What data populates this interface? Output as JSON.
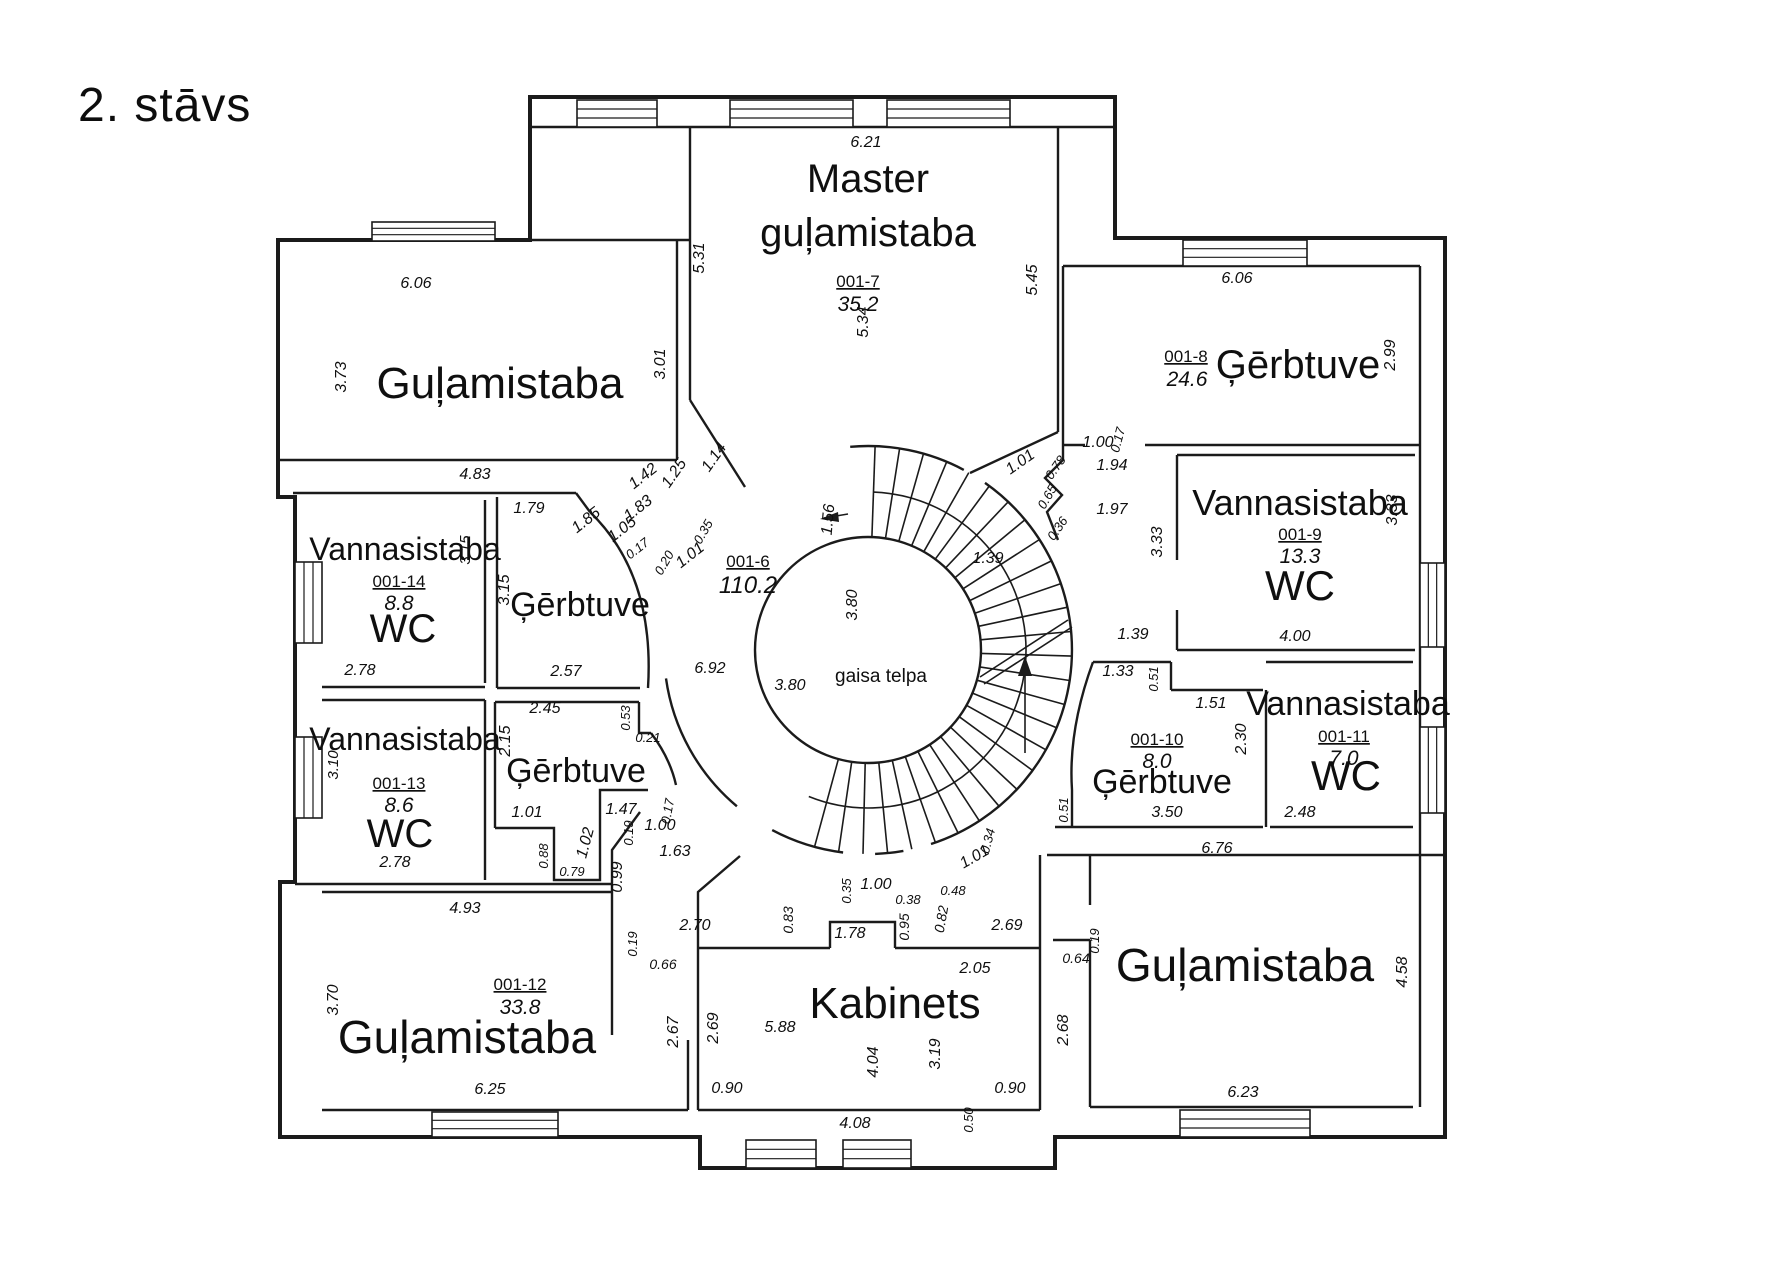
{
  "title": "2. stāvs",
  "central_void_label": "gaisa telpa",
  "rooms": [
    {
      "name": "Guļamistaba",
      "number": "",
      "area": "",
      "position": "top-left"
    },
    {
      "name": "Master guļamistaba",
      "number": "001-7",
      "area": "35.2",
      "position": "top-center"
    },
    {
      "name": "Ģērbtuve",
      "number": "001-8",
      "area": "24.6",
      "position": "top-right"
    },
    {
      "name": "Vannasistaba WC",
      "number": "001-9",
      "area": "13.3",
      "position": "right"
    },
    {
      "name": "Vannasistaba WC",
      "number": "001-14",
      "area": "8.8",
      "position": "left-upper"
    },
    {
      "name": "Ģērbtuve",
      "number": "",
      "area": "",
      "position": "left-upper-center"
    },
    {
      "name": "Halle",
      "number": "001-6",
      "area": "110.2",
      "position": "center"
    },
    {
      "name": "Vannasistaba WC",
      "number": "001-13",
      "area": "8.6",
      "position": "left-lower"
    },
    {
      "name": "Ģērbtuve",
      "number": "",
      "area": "",
      "position": "left-lower-center"
    },
    {
      "name": "Ģērbtuve",
      "number": "001-10",
      "area": "8.0",
      "position": "right-lower"
    },
    {
      "name": "Vannasistaba WC",
      "number": "001-11",
      "area": "7.0",
      "position": "right-lower-2"
    },
    {
      "name": "Guļamistaba",
      "number": "001-12",
      "area": "33.8",
      "position": "bottom-left"
    },
    {
      "name": "Kabinets",
      "number": "",
      "area": "",
      "position": "bottom-center"
    },
    {
      "name": "Guļamistaba",
      "number": "",
      "area": "",
      "position": "bottom-right"
    }
  ],
  "labels": [
    {
      "t": "Guļamistaba",
      "x": 500,
      "y": 398,
      "s": 44,
      "r": 0,
      "k": "n"
    },
    {
      "t": "Master",
      "x": 868,
      "y": 192,
      "s": 40,
      "r": 0,
      "k": "n"
    },
    {
      "t": "guļamistaba",
      "x": 868,
      "y": 246,
      "s": 40,
      "r": 0,
      "k": "n"
    },
    {
      "t": "Ģērbtuve",
      "x": 1298,
      "y": 378,
      "s": 40,
      "r": 0,
      "k": "n"
    },
    {
      "t": "Vannasistaba",
      "x": 1300,
      "y": 515,
      "s": 36,
      "r": 0,
      "k": "n"
    },
    {
      "t": "WC",
      "x": 1300,
      "y": 600,
      "s": 42,
      "r": 0,
      "k": "n"
    },
    {
      "t": "Vannasistaba",
      "x": 405,
      "y": 560,
      "s": 32,
      "r": 0,
      "k": "n"
    },
    {
      "t": "WC",
      "x": 403,
      "y": 642,
      "s": 40,
      "r": 0,
      "k": "n"
    },
    {
      "t": "Ģērbtuve",
      "x": 580,
      "y": 616,
      "s": 34,
      "r": 0,
      "k": "n"
    },
    {
      "t": "Vannasistaba",
      "x": 405,
      "y": 750,
      "s": 32,
      "r": 0,
      "k": "n"
    },
    {
      "t": "WC",
      "x": 400,
      "y": 847,
      "s": 40,
      "r": 0,
      "k": "n"
    },
    {
      "t": "Ģērbtuve",
      "x": 576,
      "y": 782,
      "s": 34,
      "r": 0,
      "k": "n"
    },
    {
      "t": "Ģērbtuve",
      "x": 1162,
      "y": 793,
      "s": 34,
      "r": 0,
      "k": "n"
    },
    {
      "t": "Vannasistaba",
      "x": 1348,
      "y": 715,
      "s": 34,
      "r": 0,
      "k": "n"
    },
    {
      "t": "WC",
      "x": 1346,
      "y": 790,
      "s": 42,
      "r": 0,
      "k": "n"
    },
    {
      "t": "Guļamistaba",
      "x": 467,
      "y": 1053,
      "s": 46,
      "r": 0,
      "k": "n"
    },
    {
      "t": "Kabinets",
      "x": 895,
      "y": 1018,
      "s": 44,
      "r": 0,
      "k": "n"
    },
    {
      "t": "Guļamistaba",
      "x": 1245,
      "y": 981,
      "s": 46,
      "r": 0,
      "k": "n"
    },
    {
      "t": "gaisa telpa",
      "x": 881,
      "y": 682,
      "s": 19,
      "r": 0,
      "k": "t"
    },
    {
      "t": "001-7",
      "x": 858,
      "y": 287,
      "s": 17,
      "r": 0,
      "k": "u"
    },
    {
      "t": "35.2",
      "x": 858,
      "y": 311,
      "s": 21,
      "r": 0,
      "k": "a"
    },
    {
      "t": "001-8",
      "x": 1186,
      "y": 362,
      "s": 17,
      "r": 0,
      "k": "u"
    },
    {
      "t": "24.6",
      "x": 1187,
      "y": 386,
      "s": 21,
      "r": 0,
      "k": "a"
    },
    {
      "t": "001-9",
      "x": 1300,
      "y": 540,
      "s": 17,
      "r": 0,
      "k": "u"
    },
    {
      "t": "13.3",
      "x": 1300,
      "y": 563,
      "s": 21,
      "r": 0,
      "k": "a"
    },
    {
      "t": "001-14",
      "x": 399,
      "y": 587,
      "s": 17,
      "r": 0,
      "k": "u"
    },
    {
      "t": "8.8",
      "x": 399,
      "y": 610,
      "s": 21,
      "r": 0,
      "k": "a"
    },
    {
      "t": "001-13",
      "x": 399,
      "y": 789,
      "s": 17,
      "r": 0,
      "k": "u"
    },
    {
      "t": "8.6",
      "x": 399,
      "y": 812,
      "s": 21,
      "r": 0,
      "k": "a"
    },
    {
      "t": "001-10",
      "x": 1157,
      "y": 745,
      "s": 17,
      "r": 0,
      "k": "u"
    },
    {
      "t": "8.0",
      "x": 1157,
      "y": 768,
      "s": 21,
      "r": 0,
      "k": "a"
    },
    {
      "t": "001-11",
      "x": 1344,
      "y": 742,
      "s": 17,
      "r": 0,
      "k": "u"
    },
    {
      "t": "7.0",
      "x": 1344,
      "y": 765,
      "s": 21,
      "r": 0,
      "k": "a"
    },
    {
      "t": "001-12",
      "x": 520,
      "y": 990,
      "s": 17,
      "r": 0,
      "k": "u"
    },
    {
      "t": "33.8",
      "x": 520,
      "y": 1014,
      "s": 21,
      "r": 0,
      "k": "a"
    },
    {
      "t": "001-6",
      "x": 748,
      "y": 567,
      "s": 17,
      "r": 0,
      "k": "u"
    },
    {
      "t": "110.2",
      "x": 748,
      "y": 593,
      "s": 24,
      "r": 0,
      "k": "a"
    },
    {
      "t": "6.21",
      "x": 866,
      "y": 147,
      "s": 16,
      "r": 0,
      "k": "d"
    },
    {
      "t": "5.31",
      "x": 704,
      "y": 258,
      "s": 16,
      "r": -90,
      "k": "d"
    },
    {
      "t": "5.45",
      "x": 1037,
      "y": 280,
      "s": 16,
      "r": -90,
      "k": "d"
    },
    {
      "t": "5.34",
      "x": 868,
      "y": 322,
      "s": 16,
      "r": -90,
      "k": "d"
    },
    {
      "t": "6.06",
      "x": 416,
      "y": 288,
      "s": 16,
      "r": 0,
      "k": "d"
    },
    {
      "t": "3.73",
      "x": 346,
      "y": 377,
      "s": 16,
      "r": -90,
      "k": "d"
    },
    {
      "t": "3.01",
      "x": 665,
      "y": 364,
      "s": 16,
      "r": -90,
      "k": "d"
    },
    {
      "t": "6.06",
      "x": 1237,
      "y": 283,
      "s": 16,
      "r": 0,
      "k": "d"
    },
    {
      "t": "2.99",
      "x": 1395,
      "y": 355,
      "s": 16,
      "r": -90,
      "k": "d"
    },
    {
      "t": "4.83",
      "x": 475,
      "y": 479,
      "s": 16,
      "r": 0,
      "k": "d"
    },
    {
      "t": "1.79",
      "x": 529,
      "y": 513,
      "s": 16,
      "r": 0,
      "k": "d"
    },
    {
      "t": "2.78",
      "x": 360,
      "y": 675,
      "s": 16,
      "r": 0,
      "k": "d"
    },
    {
      "t": "3.15",
      "x": 470,
      "y": 550,
      "s": 15,
      "r": -90,
      "k": "d"
    },
    {
      "t": "3.15",
      "x": 509,
      "y": 590,
      "s": 16,
      "r": -90,
      "k": "d"
    },
    {
      "t": "2.57",
      "x": 566,
      "y": 676,
      "s": 16,
      "r": 0,
      "k": "d"
    },
    {
      "t": "1.42",
      "x": 646,
      "y": 480,
      "s": 16,
      "r": -38,
      "k": "d"
    },
    {
      "t": "1.25",
      "x": 678,
      "y": 476,
      "s": 16,
      "r": -55,
      "k": "d"
    },
    {
      "t": "1.83",
      "x": 641,
      "y": 512,
      "s": 16,
      "r": -38,
      "k": "d"
    },
    {
      "t": "1.14",
      "x": 718,
      "y": 460,
      "s": 16,
      "r": -55,
      "k": "d"
    },
    {
      "t": "1.85",
      "x": 589,
      "y": 524,
      "s": 16,
      "r": -38,
      "k": "d"
    },
    {
      "t": "1.05",
      "x": 625,
      "y": 533,
      "s": 16,
      "r": -38,
      "k": "d"
    },
    {
      "t": "0.17",
      "x": 640,
      "y": 552,
      "s": 13,
      "r": -38,
      "k": "d"
    },
    {
      "t": "0.20",
      "x": 668,
      "y": 565,
      "s": 13,
      "r": -60,
      "k": "d"
    },
    {
      "t": "0.35",
      "x": 707,
      "y": 534,
      "s": 13,
      "r": -60,
      "k": "d"
    },
    {
      "t": "1.01",
      "x": 693,
      "y": 559,
      "s": 16,
      "r": -38,
      "k": "d"
    },
    {
      "t": "1.56",
      "x": 833,
      "y": 520,
      "s": 16,
      "r": -85,
      "k": "d"
    },
    {
      "t": "3.80",
      "x": 857,
      "y": 605,
      "s": 16,
      "r": -90,
      "k": "d"
    },
    {
      "t": "3.80",
      "x": 790,
      "y": 690,
      "s": 16,
      "r": 0,
      "k": "d"
    },
    {
      "t": "6.92",
      "x": 710,
      "y": 673,
      "s": 16,
      "r": 0,
      "k": "d"
    },
    {
      "t": "1.01",
      "x": 1023,
      "y": 466,
      "s": 16,
      "r": -35,
      "k": "d"
    },
    {
      "t": "0.78",
      "x": 1059,
      "y": 470,
      "s": 13,
      "r": -55,
      "k": "d"
    },
    {
      "t": "0.65",
      "x": 1051,
      "y": 499,
      "s": 13,
      "r": -60,
      "k": "d"
    },
    {
      "t": "0.36",
      "x": 1061,
      "y": 531,
      "s": 13,
      "r": -55,
      "k": "d"
    },
    {
      "t": "1.00",
      "x": 1098,
      "y": 447,
      "s": 16,
      "r": 0,
      "k": "d"
    },
    {
      "t": "0.17",
      "x": 1122,
      "y": 441,
      "s": 13,
      "r": -75,
      "k": "d"
    },
    {
      "t": "1.94",
      "x": 1112,
      "y": 470,
      "s": 16,
      "r": 0,
      "k": "d"
    },
    {
      "t": "1.97",
      "x": 1112,
      "y": 514,
      "s": 16,
      "r": 0,
      "k": "d"
    },
    {
      "t": "3.33",
      "x": 1162,
      "y": 542,
      "s": 16,
      "r": -90,
      "k": "d"
    },
    {
      "t": "3.33",
      "x": 1397,
      "y": 510,
      "s": 16,
      "r": -90,
      "k": "d"
    },
    {
      "t": "4.00",
      "x": 1295,
      "y": 641,
      "s": 16,
      "r": 0,
      "k": "d"
    },
    {
      "t": "1.39",
      "x": 1133,
      "y": 639,
      "s": 16,
      "r": 0,
      "k": "d"
    },
    {
      "t": "1.39",
      "x": 988,
      "y": 563,
      "s": 16,
      "r": 0,
      "k": "d"
    },
    {
      "t": "2.78",
      "x": 395,
      "y": 867,
      "s": 16,
      "r": 0,
      "k": "d"
    },
    {
      "t": "3.10",
      "x": 338,
      "y": 765,
      "s": 15,
      "r": -90,
      "k": "d"
    },
    {
      "t": "2.45",
      "x": 545,
      "y": 713,
      "s": 16,
      "r": 0,
      "k": "d"
    },
    {
      "t": "2.15",
      "x": 510,
      "y": 741,
      "s": 16,
      "r": -90,
      "k": "d"
    },
    {
      "t": "0.53",
      "x": 630,
      "y": 718,
      "s": 13,
      "r": -90,
      "k": "d"
    },
    {
      "t": "0.21",
      "x": 648,
      "y": 742,
      "s": 13,
      "r": 0,
      "k": "d"
    },
    {
      "t": "1.01",
      "x": 527,
      "y": 817,
      "s": 16,
      "r": 0,
      "k": "d"
    },
    {
      "t": "1.47",
      "x": 621,
      "y": 814,
      "s": 16,
      "r": 0,
      "k": "d"
    },
    {
      "t": "0.19",
      "x": 633,
      "y": 833,
      "s": 13,
      "r": -90,
      "k": "d"
    },
    {
      "t": "1.02",
      "x": 590,
      "y": 844,
      "s": 16,
      "r": -75,
      "k": "d"
    },
    {
      "t": "0.88",
      "x": 548,
      "y": 856,
      "s": 13,
      "r": -90,
      "k": "d"
    },
    {
      "t": "0.79",
      "x": 572,
      "y": 876,
      "s": 13,
      "r": 0,
      "k": "d"
    },
    {
      "t": "0.99",
      "x": 622,
      "y": 877,
      "s": 16,
      "r": -90,
      "k": "d"
    },
    {
      "t": "1.00",
      "x": 660,
      "y": 830,
      "s": 16,
      "r": 0,
      "k": "d"
    },
    {
      "t": "0.17",
      "x": 672,
      "y": 812,
      "s": 13,
      "r": -80,
      "k": "d"
    },
    {
      "t": "1.63",
      "x": 675,
      "y": 856,
      "s": 16,
      "r": 0,
      "k": "d"
    },
    {
      "t": "1.33",
      "x": 1118,
      "y": 676,
      "s": 16,
      "r": 0,
      "k": "d"
    },
    {
      "t": "0.51",
      "x": 1158,
      "y": 679,
      "s": 13,
      "r": -90,
      "k": "d"
    },
    {
      "t": "1.51",
      "x": 1211,
      "y": 708,
      "s": 16,
      "r": 0,
      "k": "d"
    },
    {
      "t": "2.30",
      "x": 1246,
      "y": 739,
      "s": 16,
      "r": -90,
      "k": "d"
    },
    {
      "t": "0.51",
      "x": 1068,
      "y": 810,
      "s": 13,
      "r": -90,
      "k": "d"
    },
    {
      "t": "3.50",
      "x": 1167,
      "y": 817,
      "s": 16,
      "r": 0,
      "k": "d"
    },
    {
      "t": "2.48",
      "x": 1300,
      "y": 817,
      "s": 16,
      "r": 0,
      "k": "d"
    },
    {
      "t": "6.76",
      "x": 1217,
      "y": 853,
      "s": 16,
      "r": 0,
      "k": "d"
    },
    {
      "t": "0.35",
      "x": 851,
      "y": 891,
      "s": 13,
      "r": -90,
      "k": "d"
    },
    {
      "t": "1.00",
      "x": 876,
      "y": 889,
      "s": 16,
      "r": 0,
      "k": "d"
    },
    {
      "t": "0.38",
      "x": 908,
      "y": 904,
      "s": 13,
      "r": 0,
      "k": "d"
    },
    {
      "t": "0.95",
      "x": 909,
      "y": 927,
      "s": 14,
      "r": -90,
      "k": "d"
    },
    {
      "t": "0.82",
      "x": 946,
      "y": 920,
      "s": 14,
      "r": -80,
      "k": "d"
    },
    {
      "t": "0.48",
      "x": 953,
      "y": 895,
      "s": 13,
      "r": 0,
      "k": "d"
    },
    {
      "t": "0.83",
      "x": 793,
      "y": 920,
      "s": 14,
      "r": -90,
      "k": "d"
    },
    {
      "t": "1.78",
      "x": 850,
      "y": 938,
      "s": 16,
      "r": 0,
      "k": "d"
    },
    {
      "t": "2.70",
      "x": 695,
      "y": 930,
      "s": 16,
      "r": 0,
      "k": "d"
    },
    {
      "t": "2.69",
      "x": 1007,
      "y": 930,
      "s": 16,
      "r": 0,
      "k": "d"
    },
    {
      "t": "1.01",
      "x": 977,
      "y": 861,
      "s": 16,
      "r": -30,
      "k": "d"
    },
    {
      "t": "0.34",
      "x": 992,
      "y": 842,
      "s": 13,
      "r": -75,
      "k": "d"
    },
    {
      "t": "4.93",
      "x": 465,
      "y": 913,
      "s": 16,
      "r": 0,
      "k": "d"
    },
    {
      "t": "3.70",
      "x": 338,
      "y": 1000,
      "s": 16,
      "r": -90,
      "k": "d"
    },
    {
      "t": "6.25",
      "x": 490,
      "y": 1094,
      "s": 16,
      "r": 0,
      "k": "d"
    },
    {
      "t": "0.19",
      "x": 637,
      "y": 944,
      "s": 13,
      "r": -90,
      "k": "d"
    },
    {
      "t": "0.66",
      "x": 663,
      "y": 969,
      "s": 14,
      "r": 0,
      "k": "d"
    },
    {
      "t": "2.67",
      "x": 678,
      "y": 1032,
      "s": 16,
      "r": -90,
      "k": "d"
    },
    {
      "t": "2.69",
      "x": 718,
      "y": 1028,
      "s": 16,
      "r": -90,
      "k": "d"
    },
    {
      "t": "5.88",
      "x": 780,
      "y": 1032,
      "s": 16,
      "r": 0,
      "k": "d"
    },
    {
      "t": "4.04",
      "x": 878,
      "y": 1062,
      "s": 16,
      "r": -90,
      "k": "d"
    },
    {
      "t": "3.19",
      "x": 940,
      "y": 1054,
      "s": 16,
      "r": -90,
      "k": "d"
    },
    {
      "t": "0.90",
      "x": 727,
      "y": 1093,
      "s": 16,
      "r": 0,
      "k": "d"
    },
    {
      "t": "0.90",
      "x": 1010,
      "y": 1093,
      "s": 16,
      "r": 0,
      "k": "d"
    },
    {
      "t": "4.08",
      "x": 855,
      "y": 1128,
      "s": 16,
      "r": 0,
      "k": "d"
    },
    {
      "t": "0.50",
      "x": 973,
      "y": 1120,
      "s": 13,
      "r": -90,
      "k": "d"
    },
    {
      "t": "2.05",
      "x": 975,
      "y": 973,
      "s": 16,
      "r": 0,
      "k": "d"
    },
    {
      "t": "0.19",
      "x": 1099,
      "y": 941,
      "s": 13,
      "r": -90,
      "k": "d"
    },
    {
      "t": "0.64",
      "x": 1076,
      "y": 963,
      "s": 14,
      "r": 0,
      "k": "d"
    },
    {
      "t": "2.68",
      "x": 1068,
      "y": 1030,
      "s": 16,
      "r": -90,
      "k": "d"
    },
    {
      "t": "4.58",
      "x": 1407,
      "y": 972,
      "s": 16,
      "r": -90,
      "k": "d"
    },
    {
      "t": "6.23",
      "x": 1243,
      "y": 1097,
      "s": 16,
      "r": 0,
      "k": "d"
    }
  ]
}
